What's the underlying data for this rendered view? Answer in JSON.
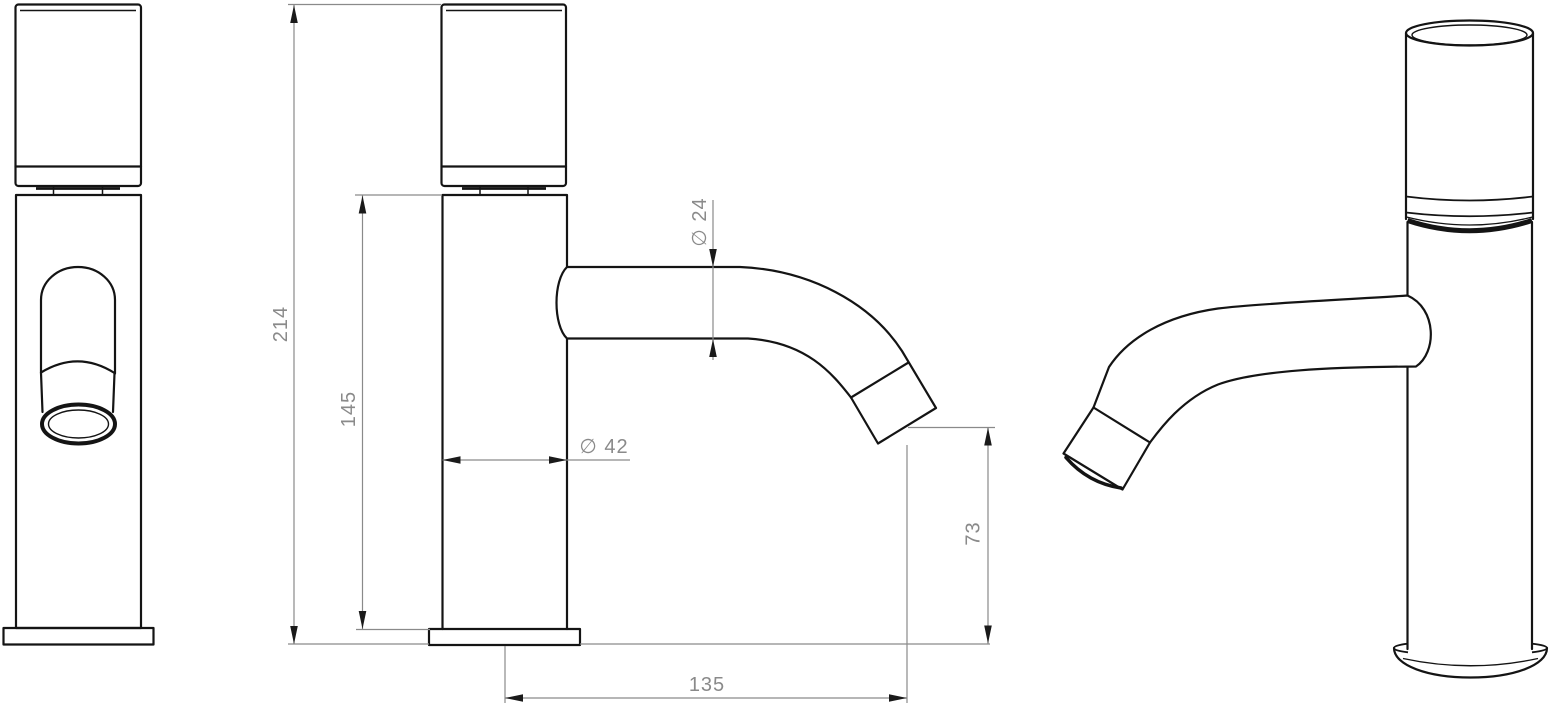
{
  "drawing": {
    "type": "technical-drawing",
    "colors": {
      "background": "#ffffff",
      "outline": "#141414",
      "dimension": "#8a8a8a"
    },
    "dimensions": {
      "total_height": "214",
      "spout_height": "145",
      "spout_diameter": "∅ 24",
      "body_diameter": "∅ 42",
      "outlet_clearance": "73",
      "spout_reach": "135"
    }
  }
}
